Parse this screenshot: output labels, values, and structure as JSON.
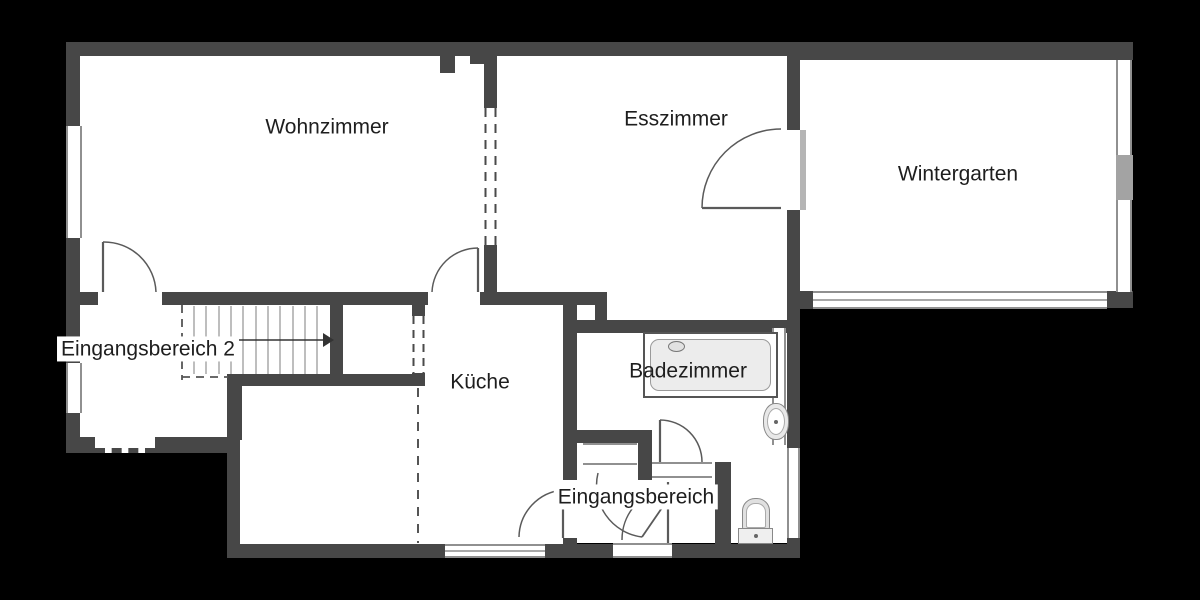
{
  "floorplan": {
    "type": "apartment-floor-plan",
    "rooms": [
      {
        "id": "wohnzimmer",
        "label": "Wohnzimmer"
      },
      {
        "id": "esszimmer",
        "label": "Esszimmer"
      },
      {
        "id": "wintergarten",
        "label": "Wintergarten"
      },
      {
        "id": "eingangsbereich2",
        "label": "Eingangsbereich 2"
      },
      {
        "id": "kueche",
        "label": "Küche"
      },
      {
        "id": "badezimmer",
        "label": "Badezimmer"
      },
      {
        "id": "eingangsbereich",
        "label": "Eingangsbereich"
      }
    ],
    "fixtures": [
      {
        "id": "bathtub",
        "room": "badezimmer"
      },
      {
        "id": "sink",
        "room": "badezimmer"
      },
      {
        "id": "toilet",
        "room": "eingangsbereich"
      },
      {
        "id": "stairs",
        "room": "eingangsbereich2",
        "direction": "up-right-arrow"
      }
    ],
    "colors": {
      "wall": "#474747",
      "floor": "#ffffff",
      "background": "#000000",
      "window_frame": "#909090",
      "fixture_fill": "#ececec",
      "door_arc": "#5a5a5a"
    }
  }
}
